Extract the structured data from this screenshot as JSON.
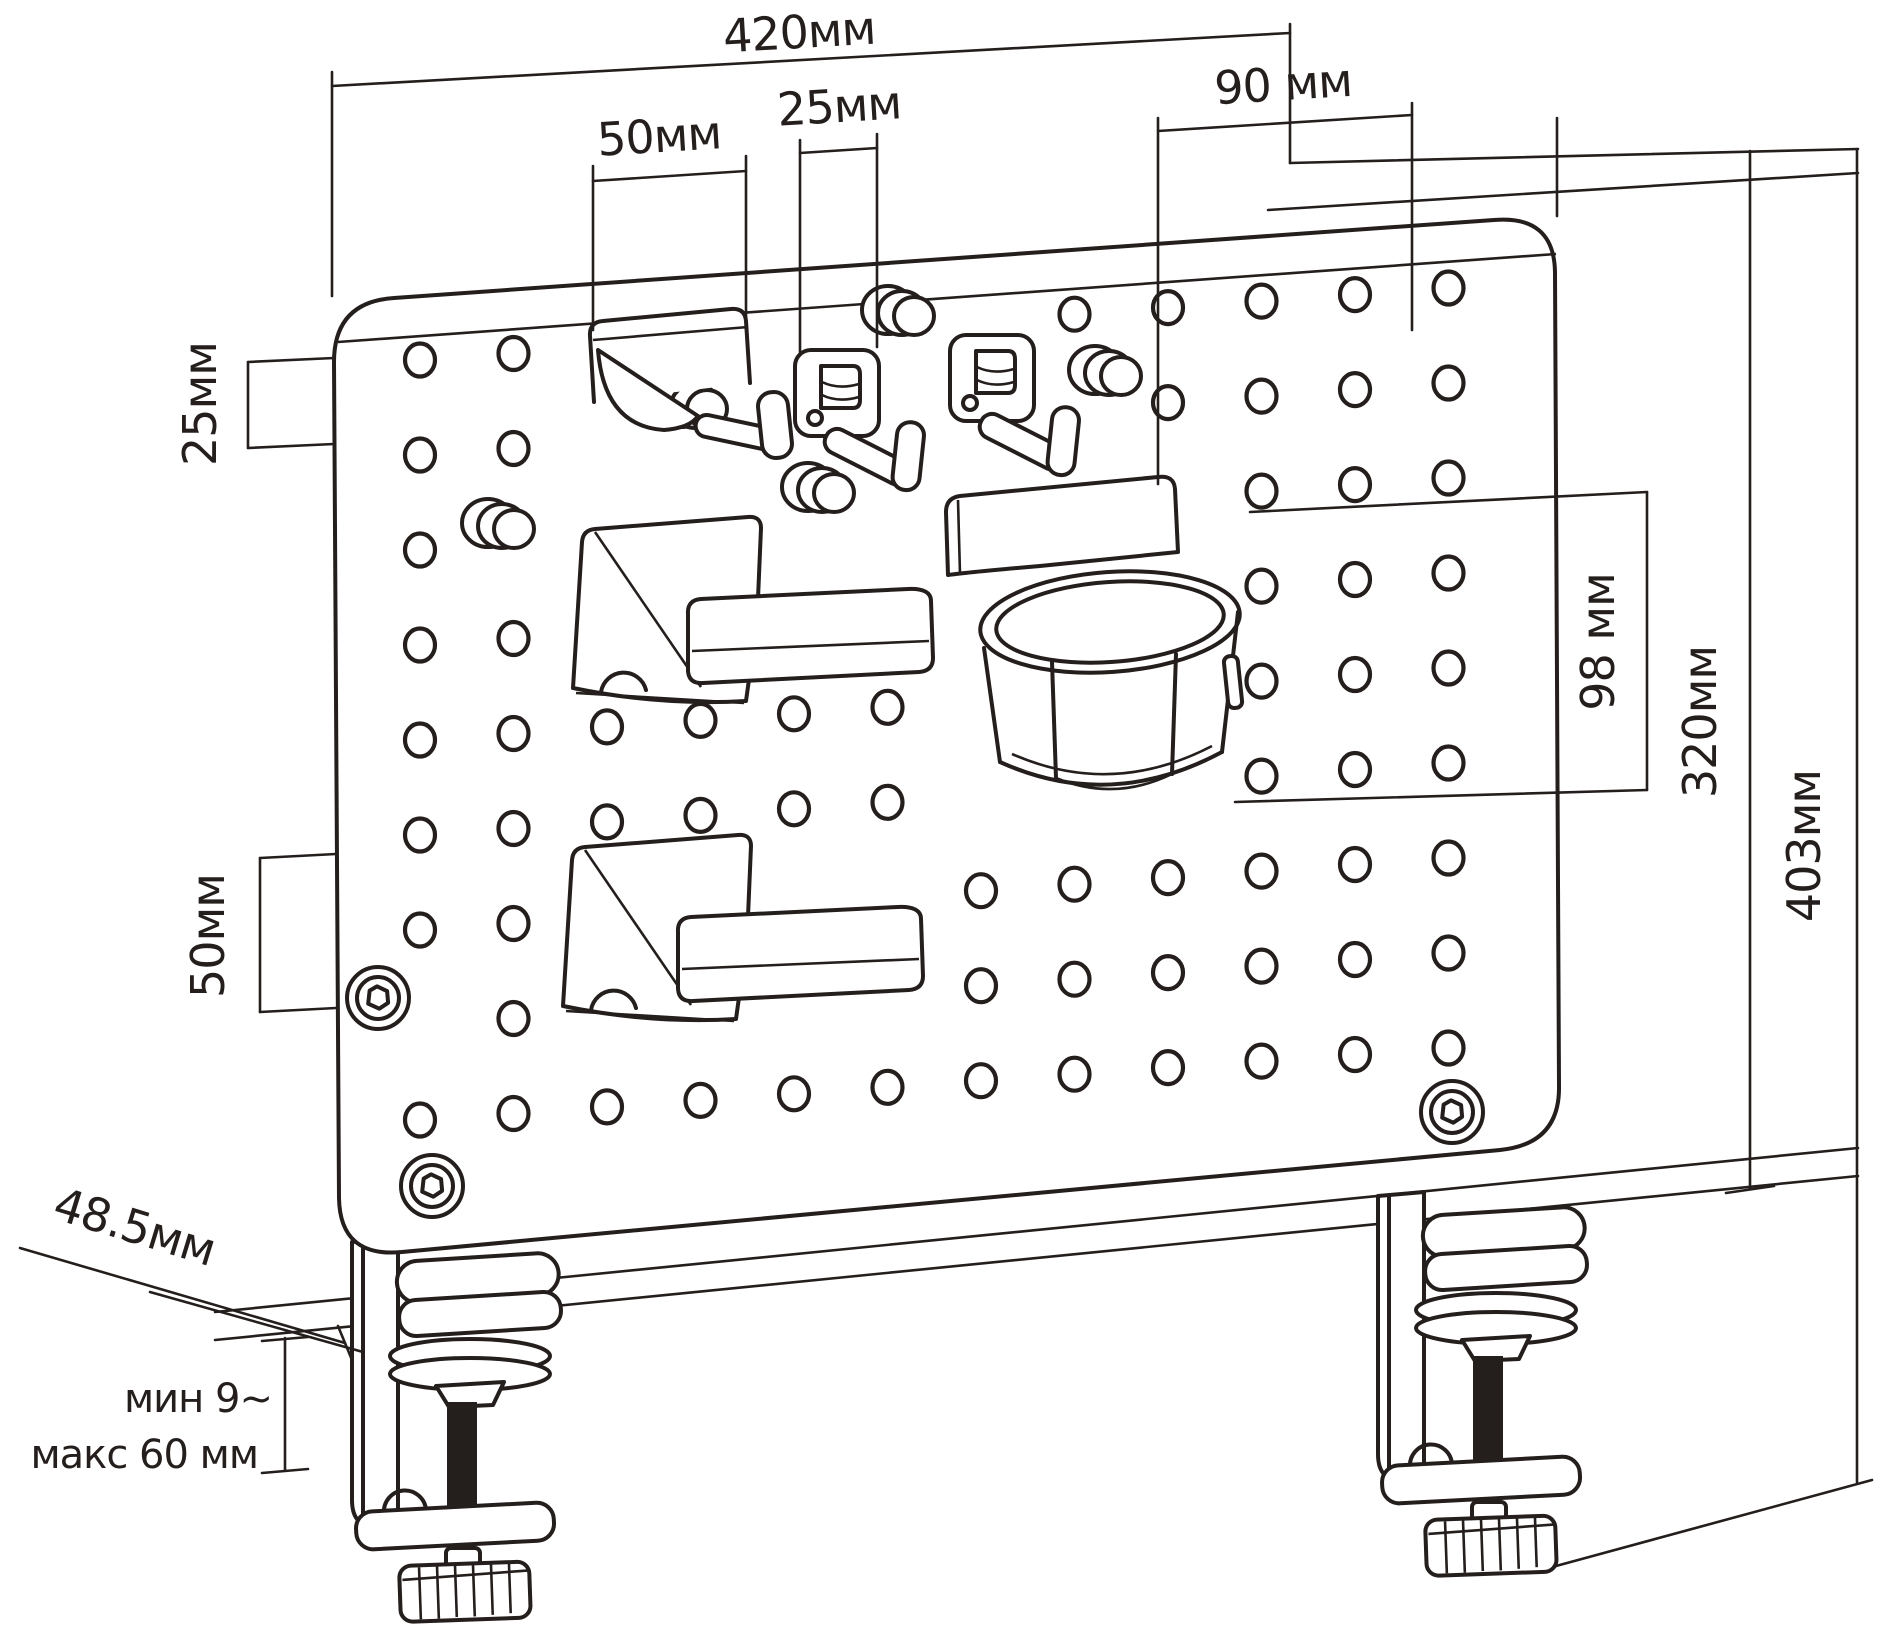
{
  "diagram": {
    "kind": "technical-dimension-drawing",
    "units": "мм",
    "background": "#ffffff",
    "line_color": "#241e1c",
    "dimension_labels": {
      "top_width": "420мм",
      "hook_width": "50мм",
      "pitch_top": "25мм",
      "cup_offset": "90 мм",
      "pitch_left": "25мм",
      "left_span": "50мм",
      "cup_height": "98 мм",
      "board_height": "320мм",
      "total_height": "403мм",
      "clamp_depth": "48.5мм",
      "clamp_min": "мин 9~",
      "clamp_max": "макс 60 мм"
    },
    "dimension_values_mm": {
      "top_width": 420,
      "hook_width": 50,
      "pitch_top": 25,
      "cup_offset": 90,
      "pitch_left": 25,
      "left_span": 50,
      "cup_height": 98,
      "board_height": 320,
      "total_height": 403,
      "clamp_depth": 48.5,
      "clamp_min": 9,
      "clamp_max": 60
    }
  }
}
